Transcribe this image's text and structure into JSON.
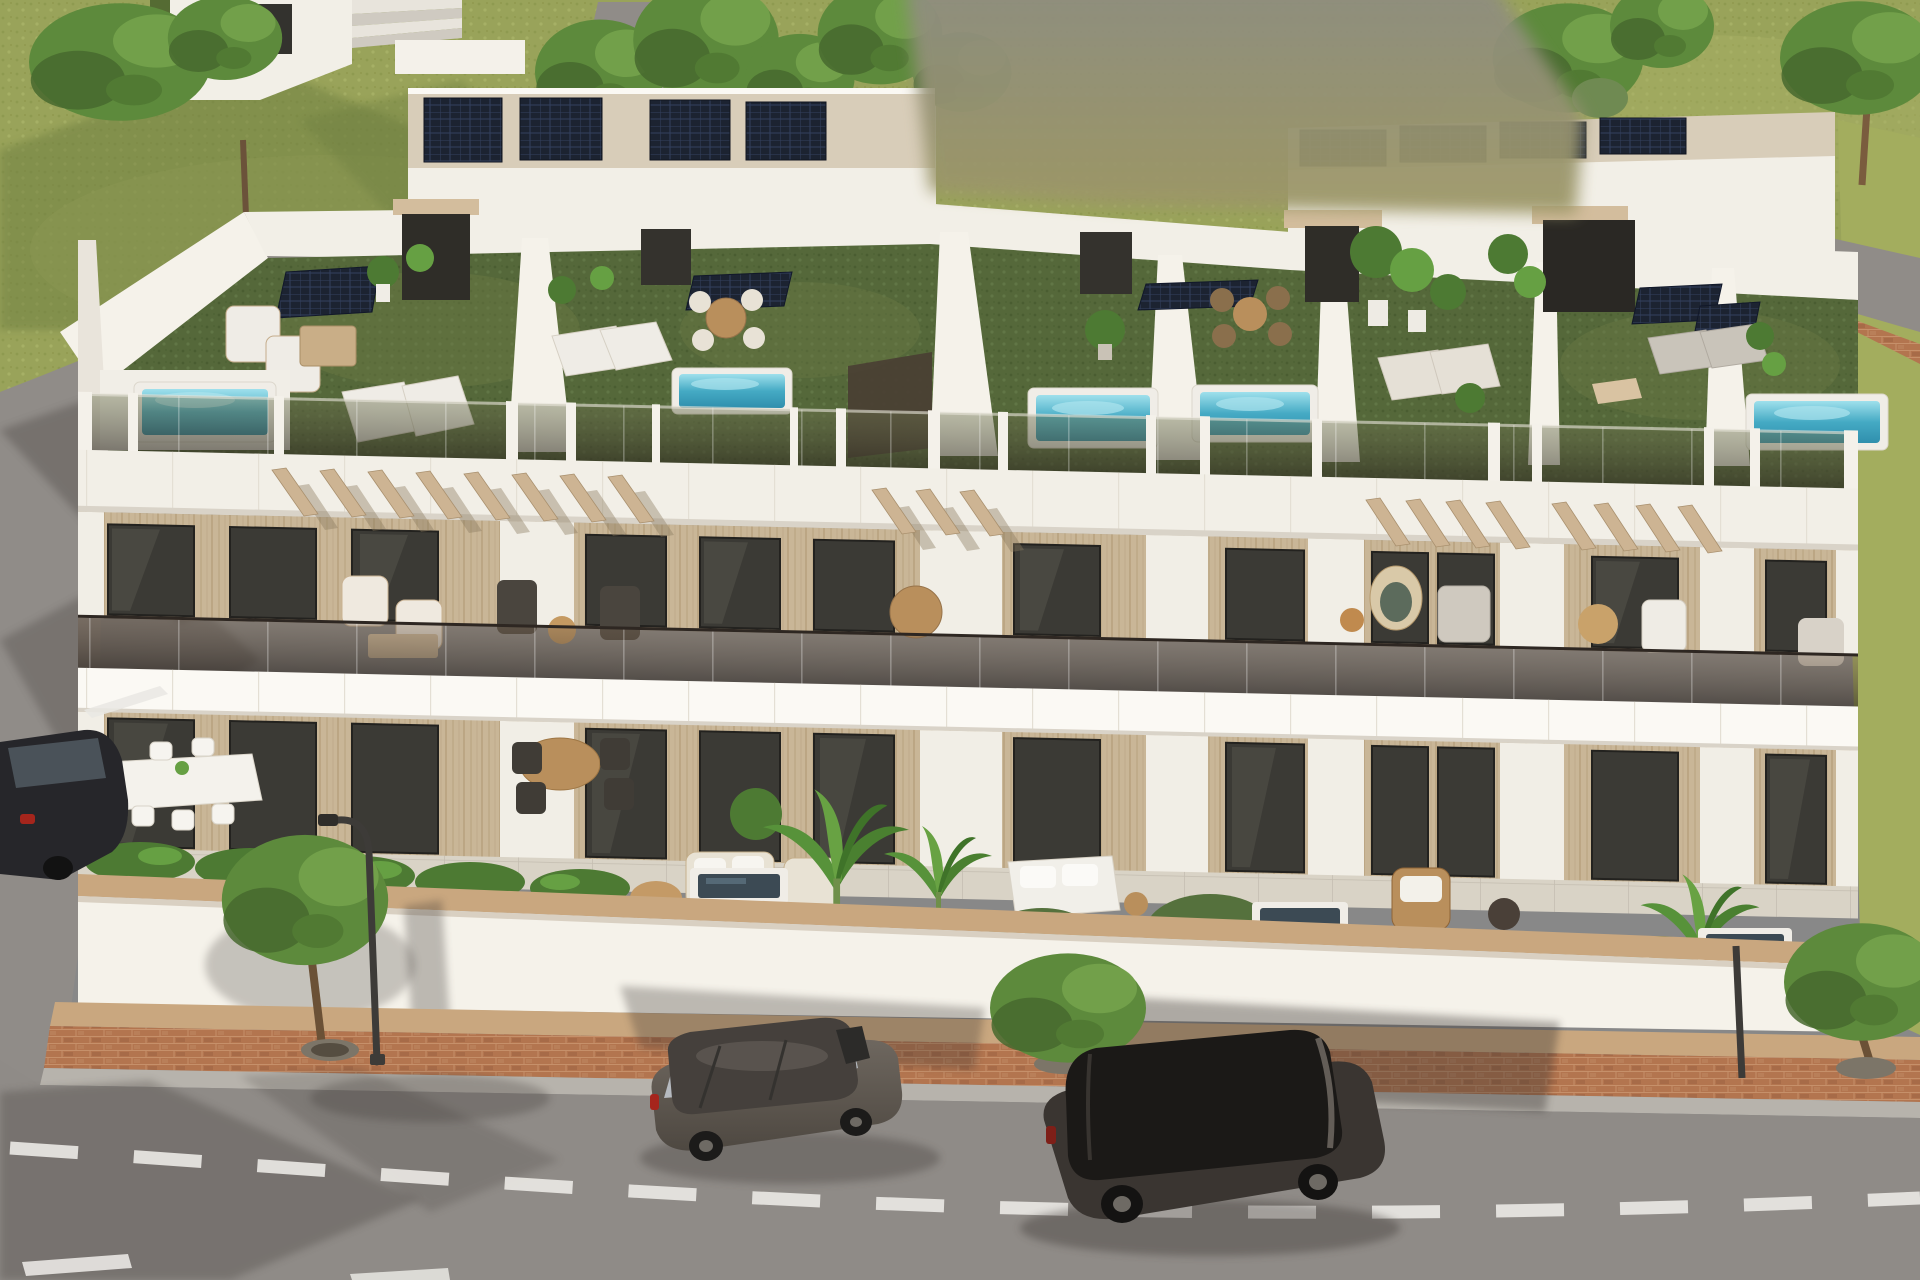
{
  "scene": {
    "description": "3D architectural exterior render: row of modern white terraced villas with rooftop garden terraces, plunge pools, solar panels, glass balustrades, ground-floor patios, and a street with two parked cars",
    "elements": [
      "rooftop-terraces",
      "rooftop-pools",
      "solar-panels",
      "pergolas",
      "balconies",
      "ground-patios",
      "perimeter-wall",
      "sidewalk",
      "street",
      "parked-cars",
      "street-trees",
      "street-lamp",
      "background-road",
      "neighbor-house",
      "blurred-watermark-patch"
    ]
  },
  "palette": {
    "grassField": "#99a35a",
    "grassLight": "#a9b266",
    "grassShadow": "#6d7e41",
    "grassStrip": "#a3ad5e",
    "roofGrassLight": "#6c7b45",
    "asphalt": "#908c88",
    "asphaltFront": "#8f8b87",
    "shadow": "#3a3530",
    "brick": "#b3754f",
    "woodCoping": "#c9a77f",
    "curb": "#b7b3ac",
    "laneMark": "#e9e7e3",
    "white": "#f2efe7",
    "whiteBright": "#fbf9f4",
    "whiteShade": "#d9d3c8",
    "wallWhite": "#f5f2ea",
    "gravel": "#d8cdb9",
    "lintel": "#d3bd9d",
    "pergola": "#cdb493",
    "windowDark": "#3b3a35",
    "windowFrame": "#23221f",
    "poolRim": "#f0ede7",
    "groundPool": "#3c4a54",
    "hedge": "#4d7a33",
    "hedgeLight": "#66a043",
    "tree": "#5d8a3c",
    "treeDark": "#47682e",
    "treeLight": "#74a24b",
    "trunk": "#6b5136",
    "planter": "#7c7568",
    "hotTub": "#8d8981",
    "car1Body": "#5e5750",
    "car1Roof": "#45403c",
    "car1Window": "#b6bac0",
    "car2Body": "#3a3531",
    "car2Roof": "#1b1917",
    "car2Window": "#211f1d",
    "alloy": "#6e6a64",
    "tailRed": "#a5251c",
    "lampPole": "#3d3b38",
    "furnitureWhite": "#efece6",
    "furnitureTan": "#c9ae87",
    "rattan": "#b98f5c"
  }
}
